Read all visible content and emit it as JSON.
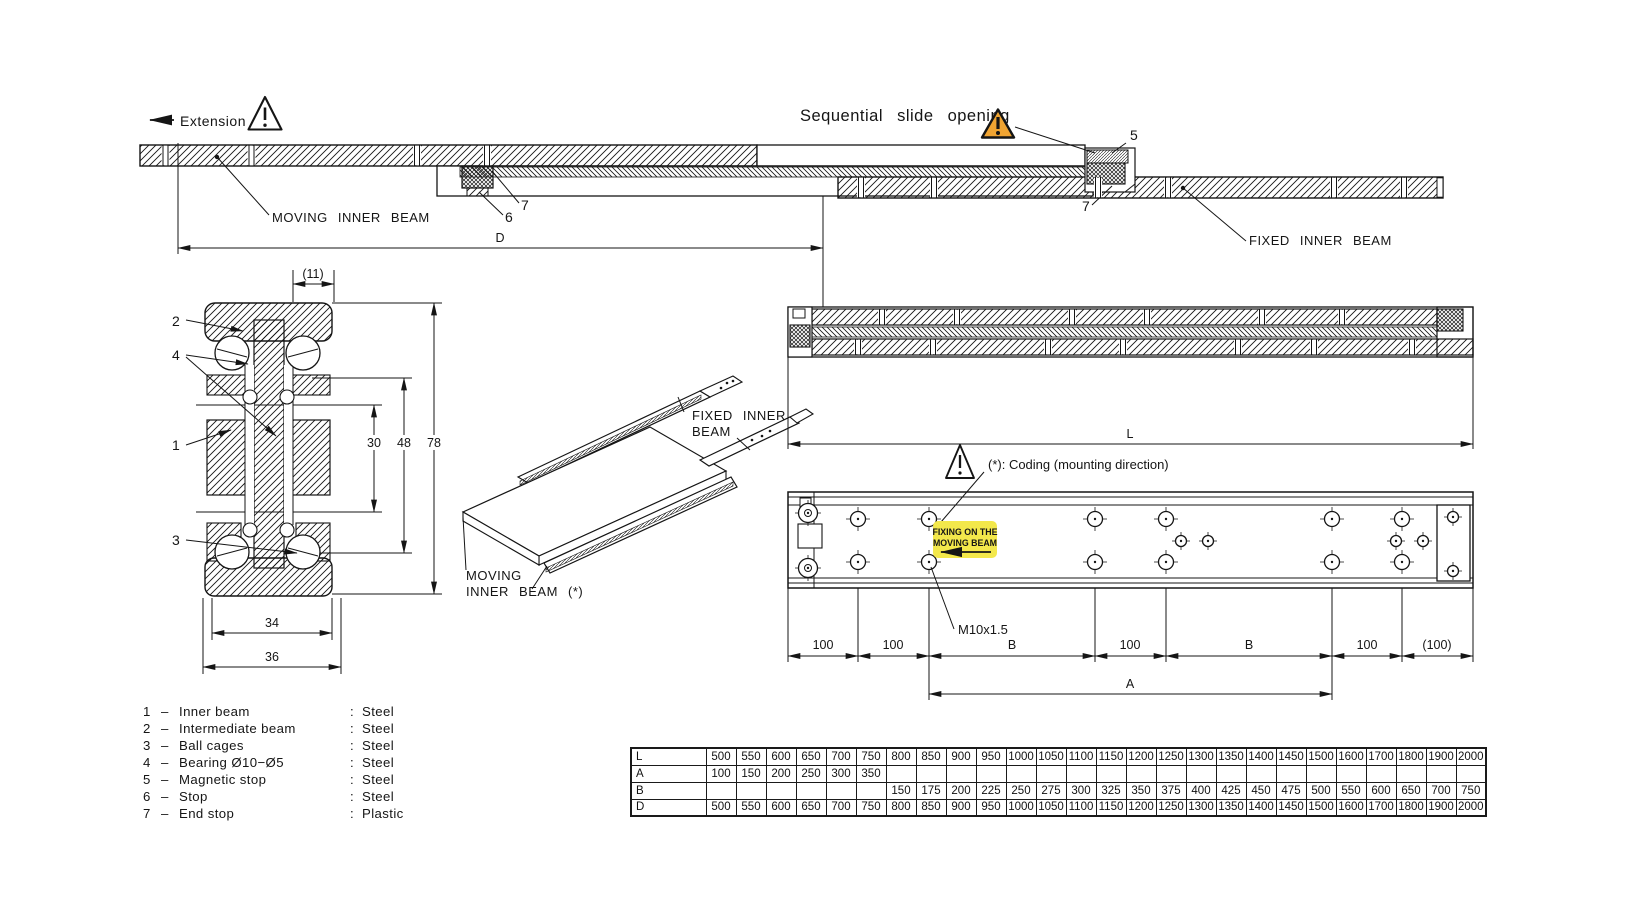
{
  "top_view": {
    "extension_label": "Extension",
    "sequential_label": "Sequential slide opening",
    "moving_beam_label": "MOVING INNER BEAM",
    "fixed_beam_label": "FIXED INNER BEAM",
    "dim_d": "D",
    "callout_5": "5",
    "callout_6": "6",
    "callout_7_left": "7",
    "callout_7_right": "7",
    "exclamation": "!"
  },
  "cross_section": {
    "dim_11": "(11)",
    "dim_30": "30",
    "dim_48": "48",
    "dim_78": "78",
    "dim_34": "34",
    "dim_36": "36",
    "callout_1": "1",
    "callout_2": "2",
    "callout_3": "3",
    "callout_4": "4"
  },
  "iso_view": {
    "fixed_line1": "FIXED INNER",
    "fixed_line2": "BEAM",
    "moving_line1": "MOVING",
    "moving_line2": "INNER BEAM (*)"
  },
  "right_views": {
    "dim_l": "L",
    "dim_a": "A",
    "coding_note": "(*): Coding (mounting direction)",
    "fixing_note_line1": "FIXING ON THE",
    "fixing_note_line2": "MOVING BEAM",
    "thread_callout": "M10x1.5",
    "dims_bottom": [
      "100",
      "100",
      "B",
      "100",
      "B",
      "100",
      "(100)"
    ]
  },
  "parts_list": [
    {
      "num": "1",
      "dash": "–",
      "name": "Inner beam",
      "colon": ":",
      "material": "Steel"
    },
    {
      "num": "2",
      "dash": "–",
      "name": "Intermediate beam",
      "colon": ":",
      "material": "Steel"
    },
    {
      "num": "3",
      "dash": "–",
      "name": "Ball cages",
      "colon": ":",
      "material": "Steel"
    },
    {
      "num": "4",
      "dash": "–",
      "name": "Bearing Ø10−Ø5",
      "colon": ":",
      "material": "Steel"
    },
    {
      "num": "5",
      "dash": "–",
      "name": "Magnetic stop",
      "colon": ":",
      "material": "Steel"
    },
    {
      "num": "6",
      "dash": "–",
      "name": "Stop",
      "colon": ":",
      "material": "Steel"
    },
    {
      "num": "7",
      "dash": "–",
      "name": "End stop",
      "colon": ":",
      "material": "Plastic"
    }
  ],
  "size_table": {
    "rows": [
      {
        "label": "L",
        "values": [
          "500",
          "550",
          "600",
          "650",
          "700",
          "750",
          "800",
          "850",
          "900",
          "950",
          "1000",
          "1050",
          "1100",
          "1150",
          "1200",
          "1250",
          "1300",
          "1350",
          "1400",
          "1450",
          "1500",
          "1600",
          "1700",
          "1800",
          "1900",
          "2000"
        ]
      },
      {
        "label": "A",
        "values": [
          "100",
          "150",
          "200",
          "250",
          "300",
          "350",
          "",
          "",
          "",
          "",
          "",
          "",
          "",
          "",
          "",
          "",
          "",
          "",
          "",
          "",
          "",
          "",
          "",
          "",
          "",
          ""
        ]
      },
      {
        "label": "B",
        "values": [
          "",
          "",
          "",
          "",
          "",
          "",
          "150",
          "175",
          "200",
          "225",
          "250",
          "275",
          "300",
          "325",
          "350",
          "375",
          "400",
          "425",
          "450",
          "475",
          "500",
          "550",
          "600",
          "650",
          "700",
          "750"
        ]
      },
      {
        "label": "D",
        "values": [
          "500",
          "550",
          "600",
          "650",
          "700",
          "750",
          "800",
          "850",
          "900",
          "950",
          "1000",
          "1050",
          "1100",
          "1150",
          "1200",
          "1250",
          "1300",
          "1350",
          "1400",
          "1450",
          "1500",
          "1600",
          "1700",
          "1800",
          "1900",
          "2000"
        ]
      }
    ]
  },
  "icons": {
    "warning_outline": "warning-triangle-icon",
    "warning_filled": "warning-triangle-filled-icon",
    "extension_arrow": "arrow-left-icon",
    "fixing_arrow": "arrow-left-icon"
  },
  "colors": {
    "line": "#151515",
    "warning_fill": "#F0A432",
    "highlight_yellow": "#F3E84B"
  }
}
